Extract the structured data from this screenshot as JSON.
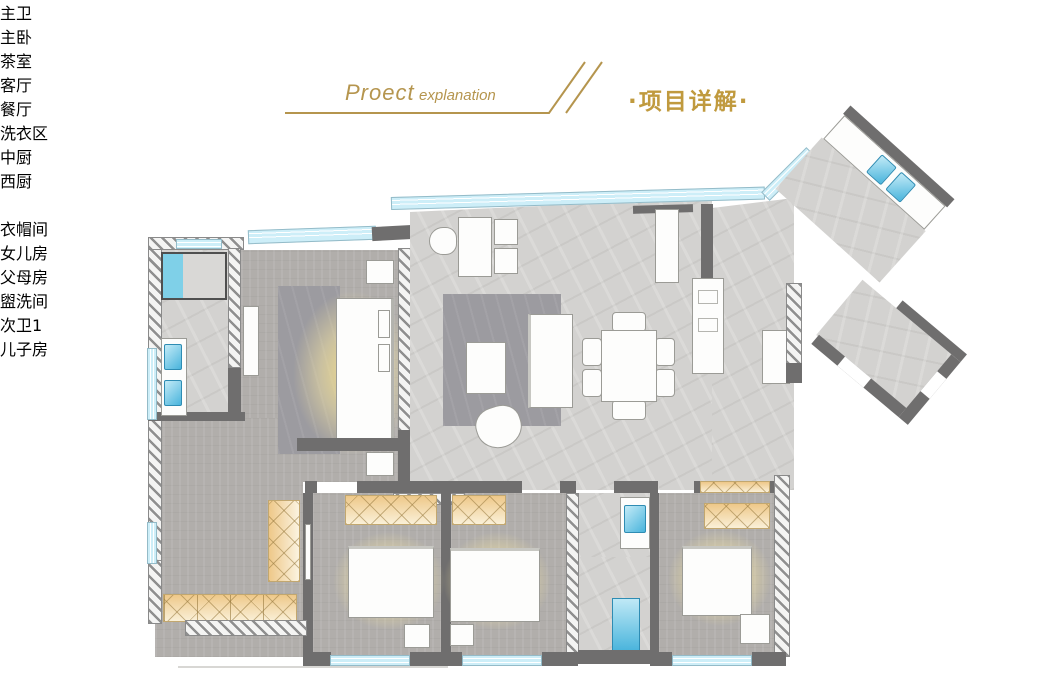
{
  "header": {
    "title_en_main": "Proect",
    "title_en_sub": "explanation",
    "title_cn": "·项目详解·",
    "accent_color": "#b5954e",
    "title_cn_color": "#c09a3e"
  },
  "palette": {
    "wall": "#6f6e6e",
    "floor_marble": "#d3d2d0",
    "floor_wood": "#b1aeab",
    "window_glass": "#cdeef8",
    "bed_glow": "#f5e08c",
    "cabinet_wood": "#eec889",
    "fixture_blue": "#49b4dc"
  },
  "floorplan": {
    "rooms": [
      {
        "id": "master-bath",
        "label": "主卫",
        "x": 190,
        "y": 339,
        "boxed": true
      },
      {
        "id": "master-bedroom",
        "label": "主卧",
        "x": 320,
        "y": 333
      },
      {
        "id": "tea-room",
        "label": "茶室",
        "x": 460,
        "y": 239
      },
      {
        "id": "living-room",
        "label": "客厅",
        "x": 462,
        "y": 358
      },
      {
        "id": "dining-room",
        "label": "餐厅",
        "x": 618,
        "y": 374
      },
      {
        "id": "laundry",
        "label": "洗衣区",
        "x": 620,
        "y": 230,
        "boxed": true
      },
      {
        "id": "chinese-kitchen",
        "label": "中厨",
        "x": 746,
        "y": 241
      },
      {
        "id": "western-kitchen",
        "label": "西厨",
        "x": 733,
        "y": 310
      },
      {
        "id": "shoe-cabinet",
        "label": "鞋柜",
        "x": 818,
        "y": 347,
        "plain": true,
        "small": true,
        "rotate": 40
      },
      {
        "id": "cloakroom",
        "label": "衣帽间",
        "x": 196,
        "y": 549
      },
      {
        "id": "daughter-room",
        "label": "女儿房",
        "x": 342,
        "y": 620
      },
      {
        "id": "parents-room",
        "label": "父母房",
        "x": 498,
        "y": 625
      },
      {
        "id": "washroom",
        "label": "盥洗间",
        "x": 575,
        "y": 519,
        "boxed": true
      },
      {
        "id": "bath-2",
        "label": "次卫1",
        "x": 582,
        "y": 623,
        "boxed": true
      },
      {
        "id": "son-room",
        "label": "儿子房",
        "x": 682,
        "y": 619
      }
    ]
  }
}
